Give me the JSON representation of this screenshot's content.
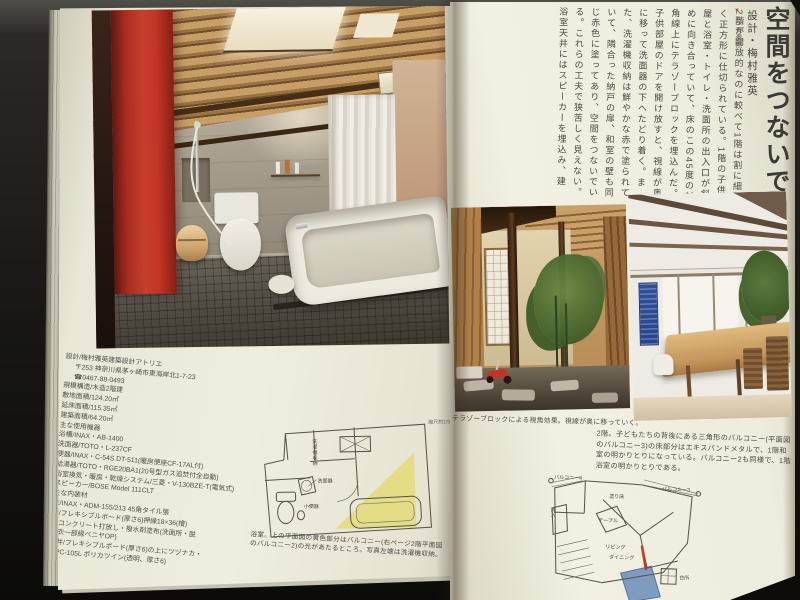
{
  "article": {
    "title": "空間をつないで",
    "designer": "設計・梅村雅英",
    "ref_marker": "▼",
    "ref": "40頁参照",
    "body": "2階が開放的なのに較べて1階は割に細かく正方形に仕切られている。1階の子供部屋と浴室・トイレ・洗面所の出入口が斜めに向き合っていて、床のこの45度の対角線上にテラゾーブロックを埋込んだ。子供部屋のドアを開け放すと、視線が奥に移って洗面器の下へたどり着く。また、洗濯機収納は鮮やかな赤で塗られていて、隣合った納戸の扉、和室の壁も同じ赤色に塗ってあり、空間をつないでいる。これらの工夫で狭苦しく見えない。浴室天井にはスピーカーを埋込み、建"
  },
  "captions": {
    "courtyard": "テラゾーブロックによる視角効果。視線が奥に移っていく。",
    "balcony": "2階。子どもたちの背後にある三角形のバルコニー(平面図のバルコニー3)の床部分はエキスパンドメタルで、1階和室の明かりとりになっている。バルコニー2も同様で、1階浴室の明かりとりである。",
    "bath": "浴室。上の平面図の黄色部分はバルコニー(右ページ2階平面図のバルコニー2)の光があたるところ。写真左端は洗濯機収納。"
  },
  "specs": {
    "lines": [
      "設計/梅村雅英建築設計アトリエ",
      "〒253 神奈川県茅ヶ崎市東海岸北1-7-23",
      "☎0467-88-0493",
      "規模構造/木造2階建",
      "敷地面積/124.20㎡",
      "延床面積/115.35㎡",
      "建築面積/64.20㎡",
      "主な使用機器",
      "浴槽/INAX・AB-1400",
      "洗面器/TOTO・L-237CF",
      "便器/INAX・C-54S DT-511(暖房便座CF-17AL付)",
      "給湯器/TOTO・RGE20BA1(20号型ガス追焚付全自動)",
      "浴室換気・暖房・乾燥システム/三菱・V-130BZE-T(電気式)",
      "スピーカー/BOSE Model 111CLT",
      "主な内装材",
      "床/INAX・ADM-155/213 45角タイル張",
      "壁/フレキシブルボード(厚さ6)押縁18×36(檜)",
      "コンクリート打放し・撥水剤塗布(洗面所・脱",
      "衣一部縁ベニヤOP)",
      "天井/フレキシブルボード(厚さ6)の上にツヅナカ・",
      "WPC-105L ポリカツイン(透明、厚さ6)"
    ]
  },
  "plan_bath": {
    "scale_note": "縮尺約1/50",
    "washer": "洗濯機収納",
    "basin": "洗面器",
    "urinal": "小便器"
  },
  "plan_2f": {
    "balcony4": "バルコニー4",
    "balcony3": "バルコニー3",
    "painted_floor": "塗り床",
    "closet": "押入",
    "table": "テーブル",
    "living": "リビング",
    "dining": "ダイニング",
    "kitchen": "台所"
  },
  "colors": {
    "page_cream": "#efecdd",
    "red_wall": "#c23b2b",
    "plan_yellow": "#e5dc86",
    "plan_blue": "#7e9cc0",
    "marker_red": "#c8502e"
  }
}
